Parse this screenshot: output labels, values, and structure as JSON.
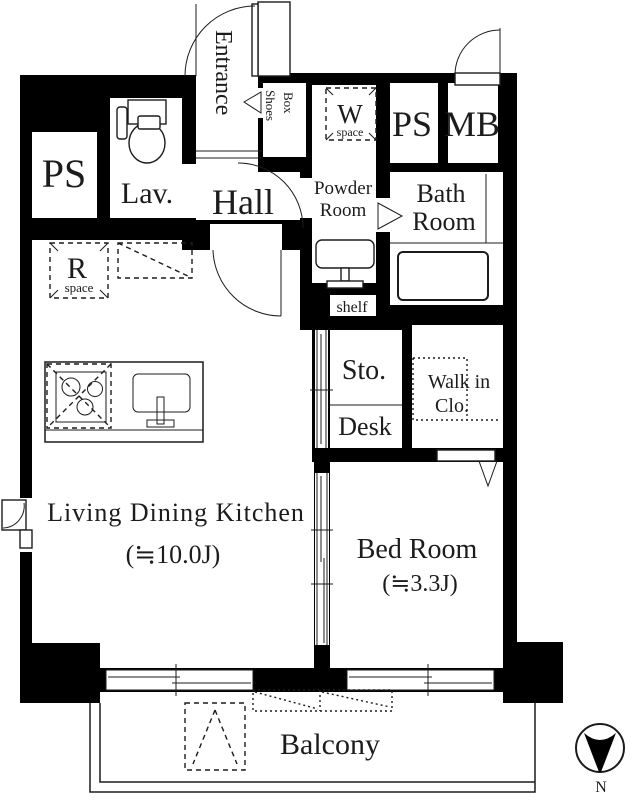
{
  "rooms": {
    "ps_left": "PS",
    "lavatory": "Lav.",
    "entrance": "Entrance",
    "shoes_box_line1": "Shoes",
    "shoes_box_line2": "Box",
    "washer_space_letter": "W",
    "washer_space_caption": "space",
    "ps_right": "PS",
    "meter_box": "MB",
    "hall": "Hall",
    "powder_room_line1": "Powder",
    "powder_room_line2": "Room",
    "bath_room_line1": "Bath",
    "bath_room_line2": "Room",
    "shelf": "shelf",
    "storage": "Sto.",
    "desk": "Desk",
    "walk_in_closet_line1": "Walk in",
    "walk_in_closet_line2": "Clo.",
    "refrigerator_space_letter": "R",
    "refrigerator_space_caption": "space",
    "ldk_name": "Living Dining Kitchen",
    "ldk_size": "(≒10.0J)",
    "bedroom_name": "Bed Room",
    "bedroom_size": "(≒3.3J)",
    "balcony": "Balcony"
  },
  "compass": {
    "label": "N"
  },
  "colors": {
    "wall": "#000000",
    "text": "#1c1c1c",
    "background": "#ffffff"
  }
}
